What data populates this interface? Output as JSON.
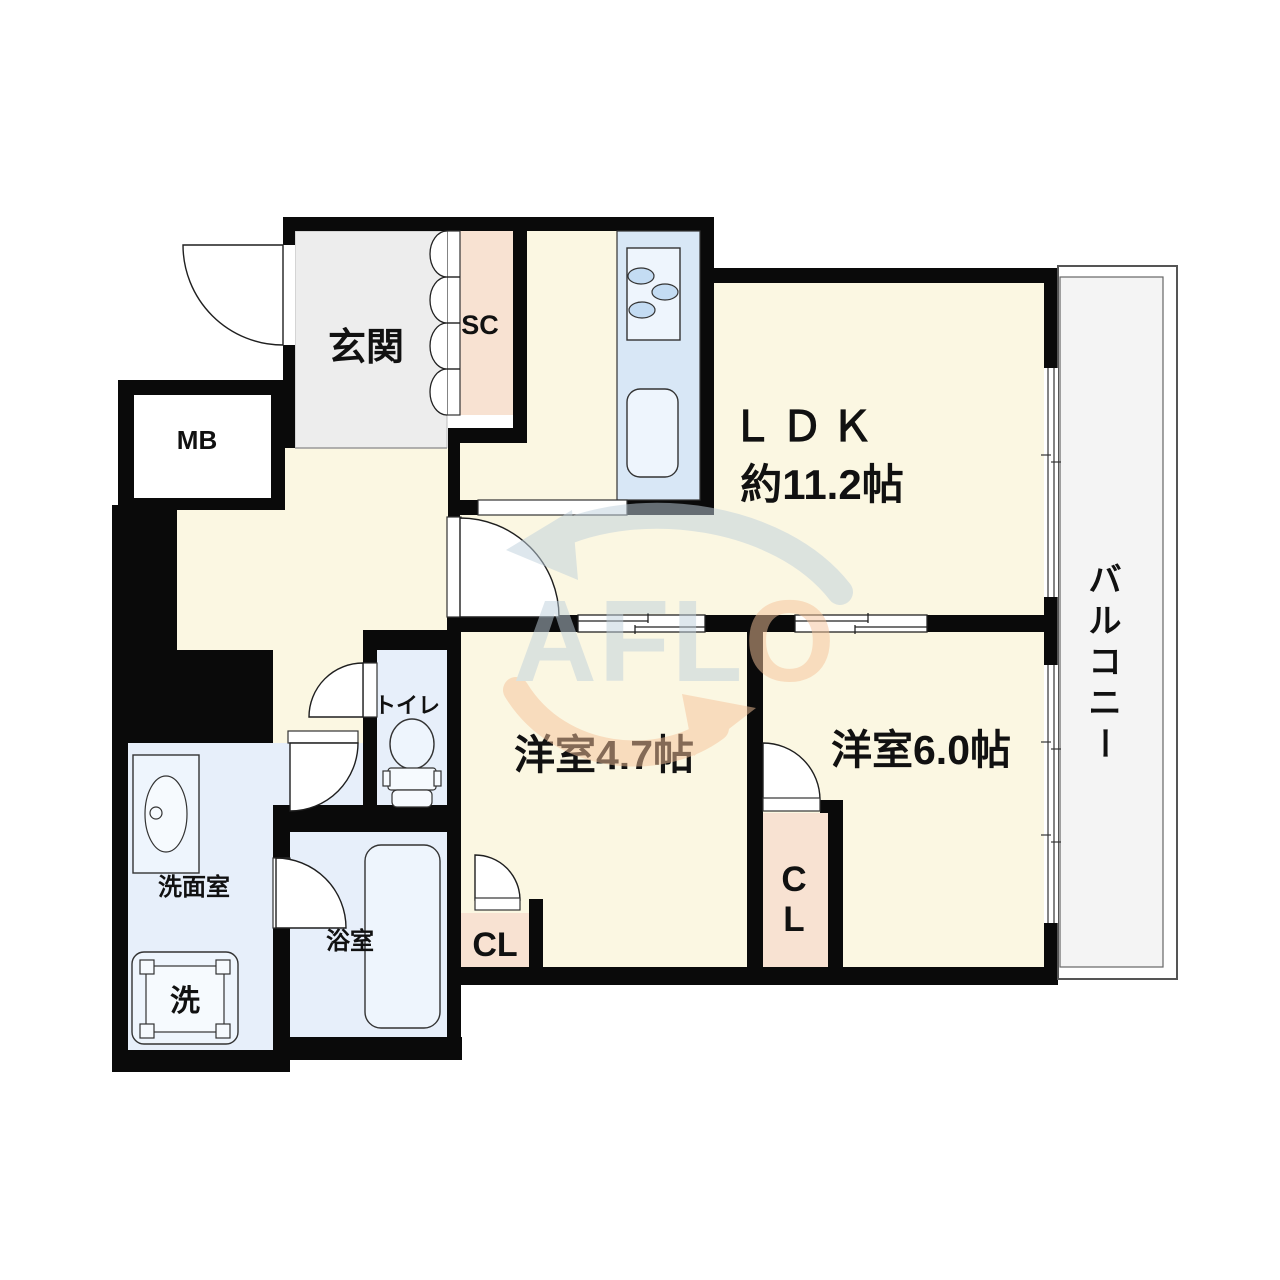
{
  "document": {
    "type": "apartment-floor-plan"
  },
  "watermark": {
    "text": "AFLO",
    "part_blue": "AFL",
    "part_orange": "O"
  },
  "rooms": {
    "genkan": {
      "label": "玄関"
    },
    "shoe_closet": {
      "label": "SC"
    },
    "meter_box": {
      "label": "MB"
    },
    "ldk": {
      "name": "ＬＤＫ",
      "size": "約11.2帖"
    },
    "bedroom_47": {
      "label": "洋室4.7帖"
    },
    "bedroom_60": {
      "label": "洋室6.0帖"
    },
    "toilet": {
      "label": "トイレ"
    },
    "washroom": {
      "label": "洗面室"
    },
    "bathroom": {
      "label": "浴室"
    },
    "washing_machine": {
      "label": "洗"
    },
    "closet_47": {
      "label": "CL"
    },
    "closet_60": {
      "char1": "C",
      "char2": "L"
    },
    "balcony": {
      "label": "バルコニー",
      "chars": [
        "バ",
        "ル",
        "コ",
        "ニ",
        "ー"
      ]
    }
  },
  "colors": {
    "wall": "#0a0a0a",
    "room_cream": "#fbf7e2",
    "closet_pink": "#f8e2d2",
    "genkan_gray": "#ededed",
    "wet_blue": "#e7effa",
    "counter_blue": "#d8e7f6",
    "fixture_fill": "#eef5fd",
    "balcony_gray": "#f4f4f4",
    "watermark_blue": "#bfd0dc",
    "watermark_orange": "#f6c39a"
  }
}
